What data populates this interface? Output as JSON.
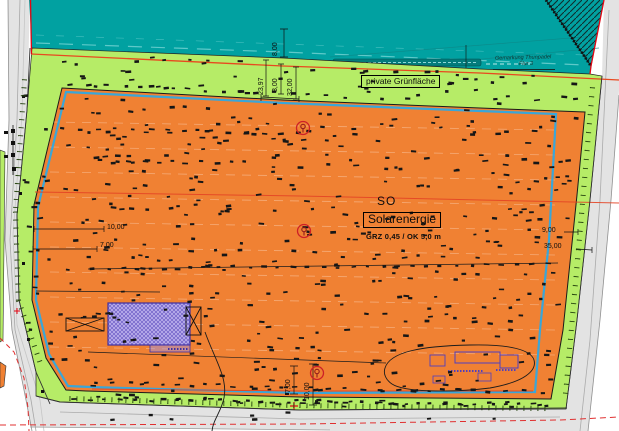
{
  "plan": {
    "zone_code": "SO",
    "zone_name": "Solarenergie",
    "zone_params": "GRZ 0,45 / OK 5,0 m",
    "green_area_label": "private Grünfläche",
    "gemarkung_line1": "Gemarkung Thunpadel",
    "gemarkung_line2": "Flur 3"
  },
  "dims": {
    "road_width": "8,00",
    "strip_a": "23,97",
    "strip_b": "3,00",
    "strip_c": "32,00",
    "left_upper": "10,00",
    "left_lower": "7,00",
    "right_upper": "9,00",
    "right_lower": "35,00",
    "bottom_left": "7,00",
    "bottom_right": "10,00"
  },
  "colors": {
    "water_teal": "#01a1a1",
    "green_area": "#b6ec67",
    "solar_orange": "#f08133",
    "so_boundary_blue": "#2fa8e1",
    "boundary_vermilion": "#e8491f",
    "cadastre_red": "#e20613",
    "building_purple": "#4f3fc0",
    "road_gray": "#e3e3e3"
  },
  "decor": {
    "seed": 11,
    "mark_color": "#161616",
    "scatter_regions": [
      {
        "poly": [
          [
            62,
            90
          ],
          [
            283,
            102
          ],
          [
            480,
            110
          ],
          [
            583,
            113
          ],
          [
            575,
            196
          ],
          [
            561,
            330
          ],
          [
            549,
            396
          ],
          [
            300,
            395
          ],
          [
            88,
            389
          ],
          [
            48,
            356
          ],
          [
            34,
            300
          ],
          [
            36,
            207
          ]
        ],
        "count": 430
      },
      {
        "poly": [
          [
            36,
            53
          ],
          [
            283,
            62
          ],
          [
            480,
            73
          ],
          [
            596,
            79
          ],
          [
            594,
            100
          ],
          [
            560,
            107
          ],
          [
            283,
            97
          ],
          [
            64,
            85
          ]
        ],
        "count": 55
      },
      {
        "poly": [
          [
            70,
            393
          ],
          [
            300,
            399
          ],
          [
            546,
            401
          ],
          [
            545,
            407
          ],
          [
            300,
            407
          ],
          [
            68,
            400
          ]
        ],
        "count": 30
      },
      {
        "poly": [
          [
            22,
            95
          ],
          [
            30,
            95
          ],
          [
            40,
            330
          ],
          [
            28,
            330
          ]
        ],
        "count": 10
      },
      {
        "poly": [
          [
            100,
            413
          ],
          [
            520,
            411
          ],
          [
            520,
            419
          ],
          [
            100,
            420
          ]
        ],
        "count": 8
      }
    ],
    "scatter_rows": [
      {
        "x0": 70,
        "x1": 350,
        "y": 84,
        "slope": 0.045,
        "step": 17
      },
      {
        "x0": 46,
        "x1": 310,
        "y": 128,
        "slope": 0.02,
        "step": 16
      },
      {
        "x0": 100,
        "x1": 245,
        "y": 161,
        "slope": 0.012,
        "step": 15
      },
      {
        "x0": 92,
        "x1": 552,
        "y": 269,
        "slope": -0.012,
        "step": 15
      },
      {
        "x0": 96,
        "x1": 540,
        "y": 383,
        "slope": 0.02,
        "step": 16
      },
      {
        "x0": 74,
        "x1": 548,
        "y": 399,
        "slope": 0.012,
        "step": 14
      }
    ],
    "hedge_ticks": {
      "color": "#25430e",
      "paths": [
        {
          "pts": [
            [
              70,
              396
            ],
            [
              300,
              403
            ],
            [
              548,
              406
            ]
          ],
          "step": 7
        },
        {
          "pts": [
            [
              27,
              80
            ],
            [
              18,
              212
            ],
            [
              21,
              300
            ],
            [
              44,
              366
            ]
          ],
          "step": 8
        },
        {
          "pts": [
            [
              595,
              88
            ],
            [
              581,
              250
            ],
            [
              568,
              396
            ]
          ],
          "step": 9
        }
      ]
    },
    "tree_markers": {
      "color": "#cd2027",
      "points": [
        [
          303,
          128
        ],
        [
          304,
          231
        ],
        [
          317,
          373
        ]
      ]
    }
  }
}
